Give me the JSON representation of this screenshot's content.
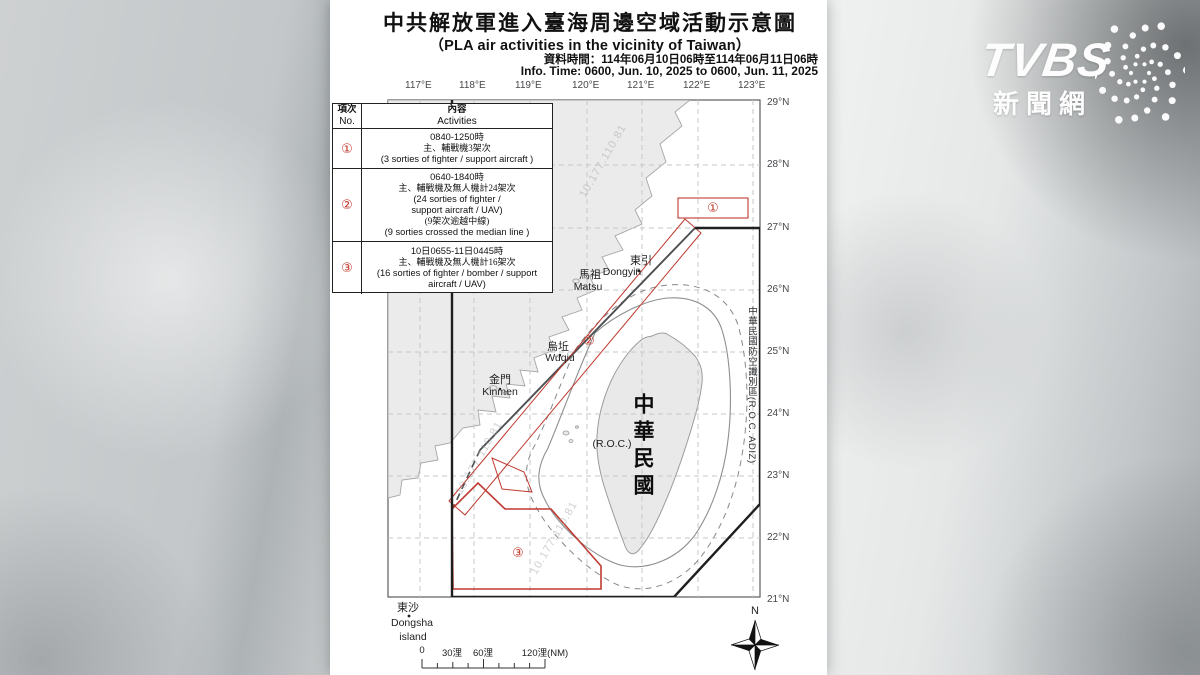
{
  "header": {
    "title_zh": "中共解放軍進入臺海周邊空域活動示意圖",
    "title_en": "（PLA air activities in the vicinity of Taiwan）",
    "info_zh": "資料時間：114年06月10日06時至114年06月11日06時",
    "info_en": "Info. Time: 0600, Jun. 10, 2025 to 0600, Jun. 11, 2025"
  },
  "table": {
    "header": {
      "no_zh": "項次",
      "no_en": "No.",
      "act_zh": "內容",
      "act_en": "Activities"
    },
    "rows": [
      {
        "no": "①",
        "lines": [
          "0840-1250時",
          "主、輔戰機3架次",
          "(3 sorties of fighter / support aircraft )"
        ]
      },
      {
        "no": "②",
        "lines": [
          "0640-1840時",
          "主、輔戰機及無人機計24架次",
          "(24 sorties of fighter /",
          "support aircraft / UAV)",
          "(9架次逾越中線)",
          "(9 sorties crossed the median line )"
        ]
      },
      {
        "no": "③",
        "lines": [
          "10日0655-11日0445時",
          "主、輔戰機及無人機計16架次",
          "(16 sorties of fighter / bomber / support",
          "aircraft / UAV)"
        ]
      }
    ]
  },
  "map": {
    "lon_labels": [
      "117°E",
      "118°E",
      "119°E",
      "120°E",
      "121°E",
      "122°E",
      "123°E"
    ],
    "lat_labels": [
      "29°N",
      "28°N",
      "27°N",
      "26°N",
      "25°N",
      "24°N",
      "23°N",
      "22°N",
      "21°N"
    ],
    "adiz_label": "中華民國防空識別區(R.O.C. ADIZ)",
    "roc_zh": "中華民國",
    "roc_en": "(R.O.C.)",
    "places": {
      "dongyin_zh": "東引",
      "dongyin_en": "Dongyin",
      "matsu_zh": "馬祖",
      "matsu_en": "Matsu",
      "wuqiu_zh": "烏坵",
      "wuqiu_en": "Wuqiu",
      "kinmen_zh": "金門",
      "kinmen_en": "Kinmen",
      "dongsha_zh": "東沙",
      "dongsha_en1": "Dongsha",
      "dongsha_en2": "island"
    },
    "zones": {
      "z1": "①",
      "z2": "②",
      "z3": "③"
    },
    "scale": {
      "s0": "0",
      "s30": "30浬",
      "s60": "60浬",
      "s120": "120浬(NM)"
    },
    "compass_n": "N",
    "watermark": "10.177.110.81",
    "colors": {
      "zone_red": "#bf3a30",
      "adiz_black": "#1f1f1f",
      "land_gray": "#ebebeb"
    }
  },
  "logo": {
    "brand": "TVBS",
    "site": "新聞網"
  }
}
